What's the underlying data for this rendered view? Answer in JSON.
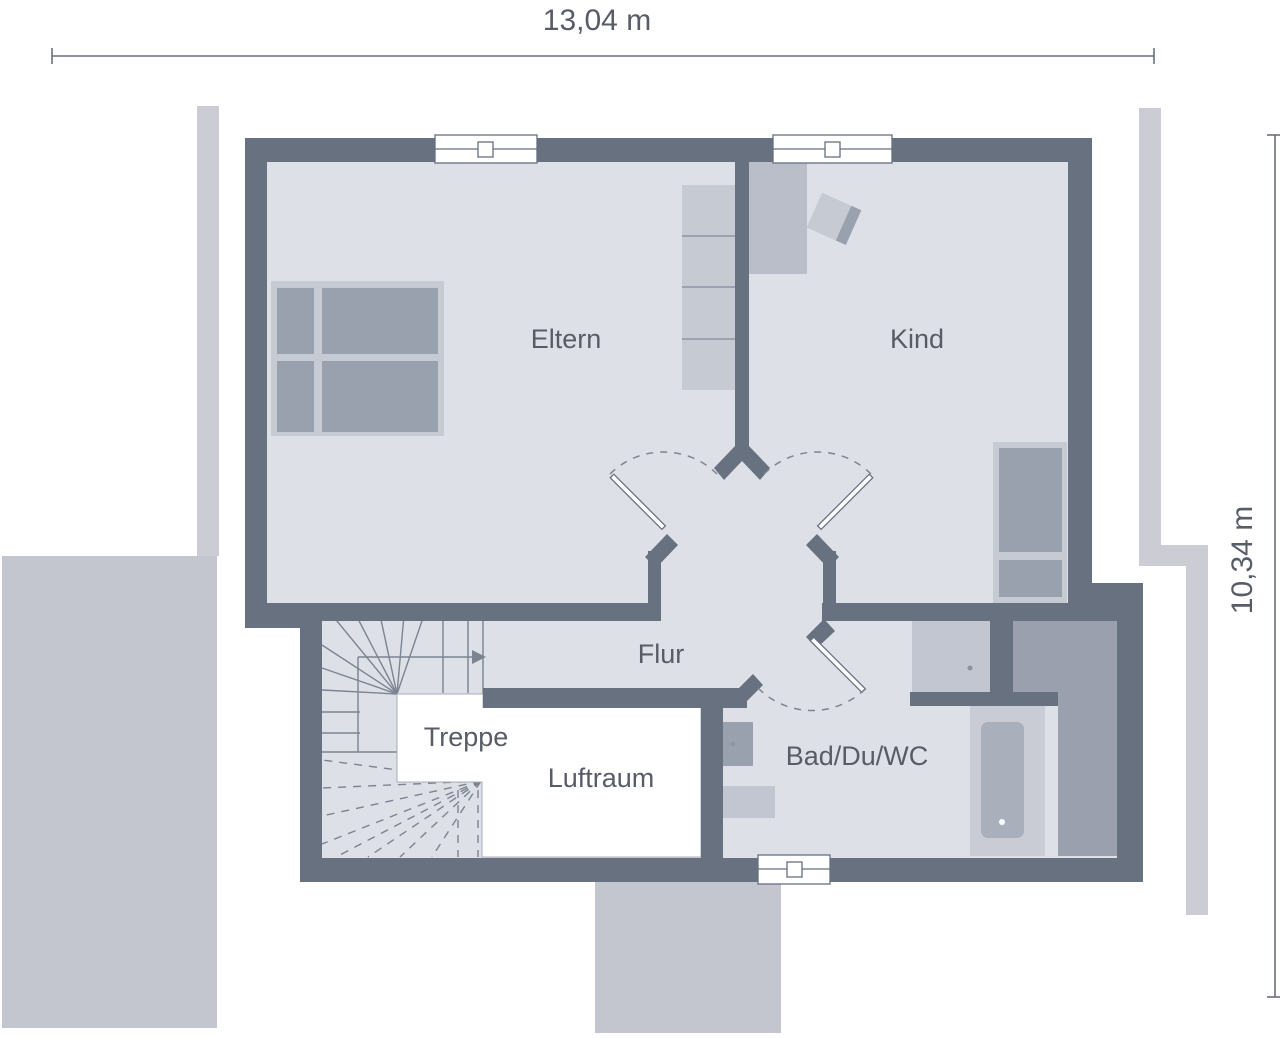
{
  "dimensions": {
    "width_label": "13,04 m",
    "height_label": "10,34 m"
  },
  "rooms": {
    "eltern": "Eltern",
    "kind": "Kind",
    "flur": "Flur",
    "treppe": "Treppe",
    "luftraum": "Luftraum",
    "bad": "Bad/Du/WC"
  },
  "icons": {
    "stair_direction_arrow": "arrow-right",
    "window_symbol": "window-pane",
    "door_swing": "dashed-arc"
  },
  "colors": {
    "wall": "#67717f",
    "room": "#dde0e7",
    "furn_light": "#c6cad3",
    "furn_mid": "#9aa1ae",
    "furn_desk": "#b9bec9",
    "zone": "#9aa0ad",
    "ext_strip": "#cbccd4",
    "ext_block": "#c4c6cf",
    "tub_surround": "#c9ccd5",
    "tub": "#a9afbb",
    "shower": "#c2c6d0",
    "stair_line": "#7c8391",
    "dim": "#6a6f79",
    "text": "#575c66",
    "cell_line": "#8d94a2"
  }
}
